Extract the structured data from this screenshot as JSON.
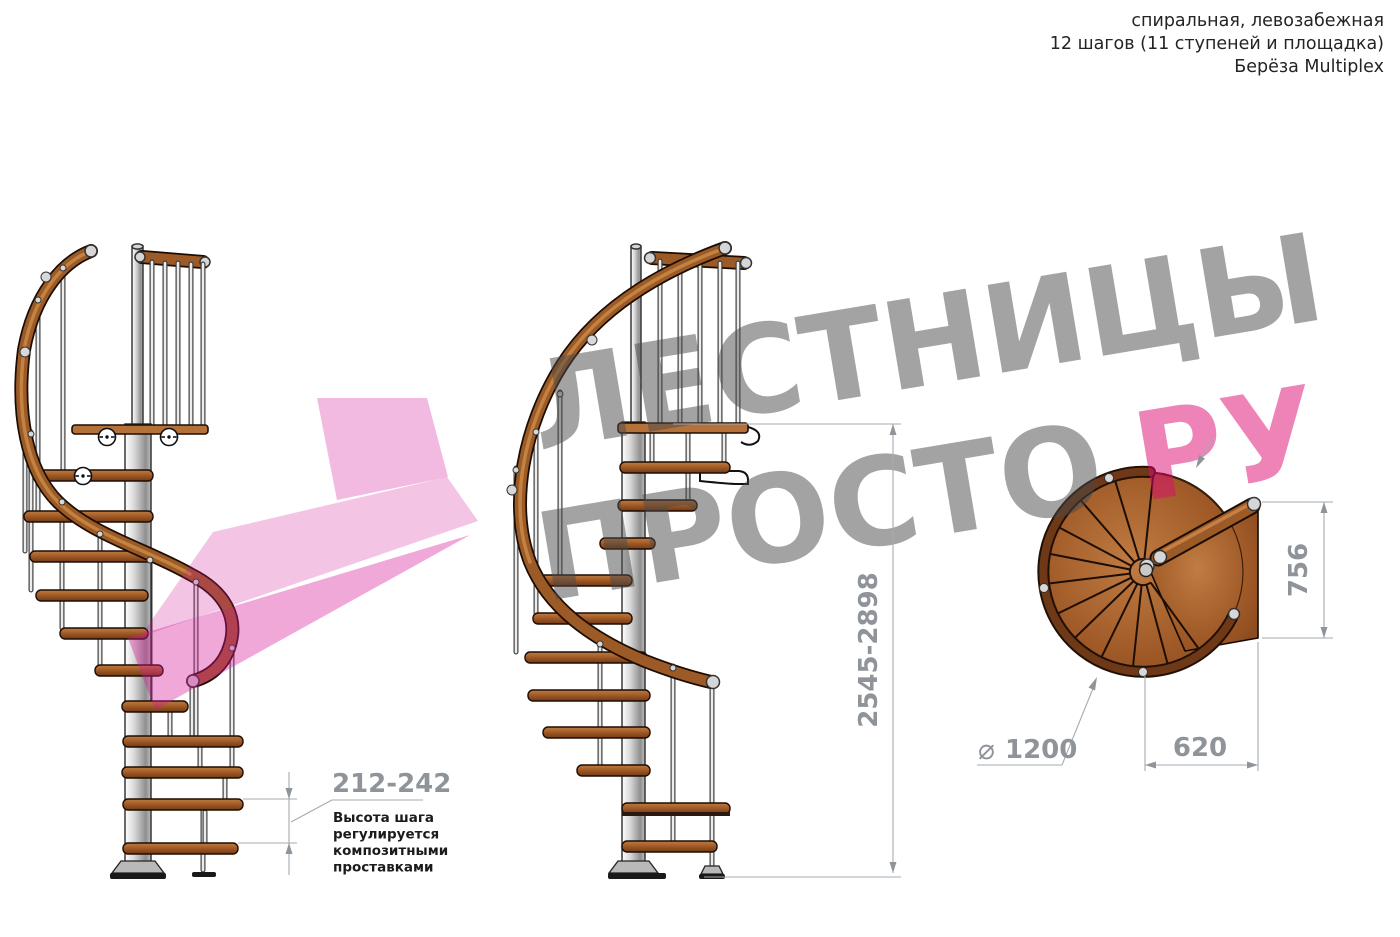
{
  "header": {
    "line1": "спиральная, левозабежная",
    "line2": "12 шагов (11 ступеней и площадка)",
    "line3": "Берёза Multiplex"
  },
  "watermark": {
    "word1": "ЛЕСТНИЦЫ",
    "word2": "ПРОСТО",
    "word3": "РУ"
  },
  "annotations": {
    "step_height": {
      "value": "212-242",
      "note_line1": "Высота шага",
      "note_line2": "регулируется",
      "note_line3": "композитными",
      "note_line4": "проставками"
    },
    "total_height": {
      "value": "2545-2898"
    },
    "landing_depth": {
      "value": "756"
    },
    "landing_width": {
      "value": "620"
    },
    "diameter": {
      "symbol": "⌀",
      "value": "1200"
    }
  },
  "colors": {
    "dimension_text": "#8e9499",
    "dimension_line": "#a6abaf",
    "watermark_gray": "#9c9c9c",
    "watermark_pink": "#ee82b4",
    "highlight_pink": "#f2b9de",
    "wood": "#a05a28",
    "wood_dark": "#6f3817",
    "metal": "#d9d9d9",
    "text_black": "#242424"
  }
}
